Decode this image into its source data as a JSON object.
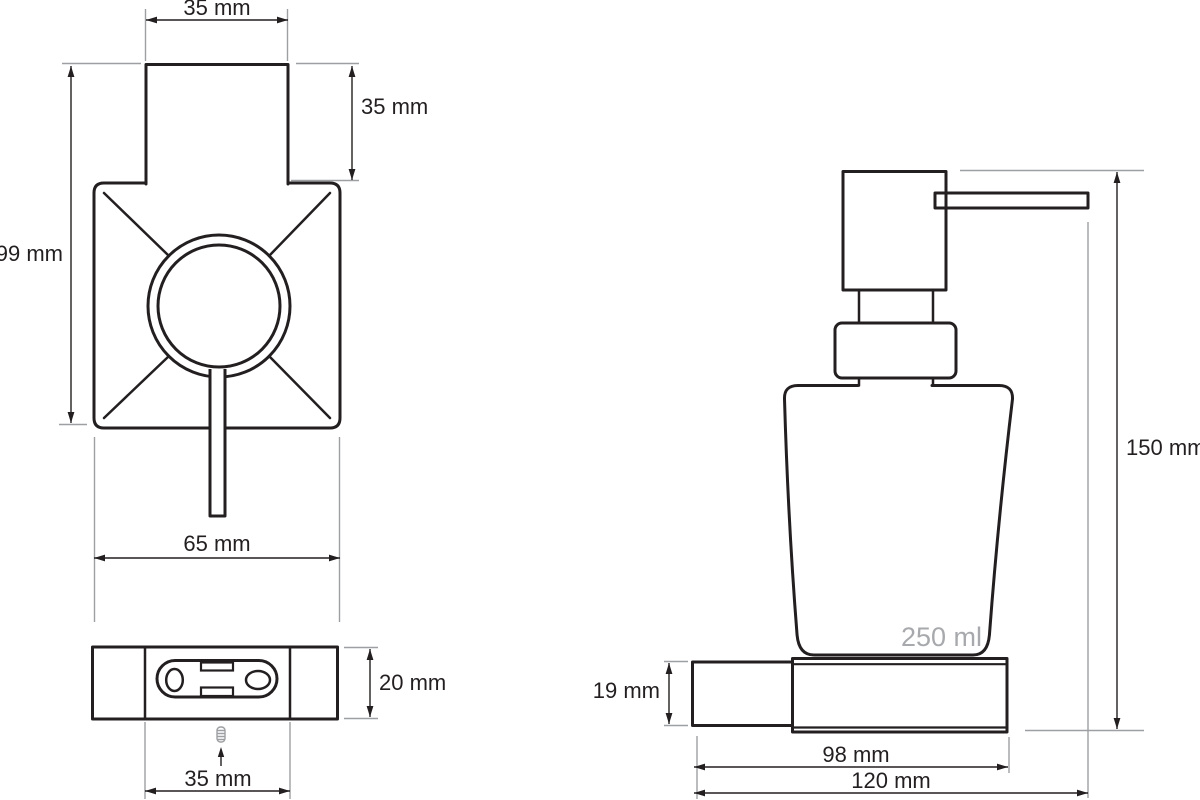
{
  "front_view": {
    "top_width": "35 mm",
    "pump_height": "35 mm",
    "total_height": "99 mm",
    "bottom_width": "65 mm"
  },
  "bottom_view": {
    "depth": "20 mm",
    "center_width": "35 mm"
  },
  "side_view": {
    "total_height": "150 mm",
    "holder_height": "19 mm",
    "holder_width": "98 mm",
    "total_width": "120 mm",
    "capacity": "250 ml"
  },
  "colors": {
    "outline": "#231f20",
    "dimension_line": "#231f20",
    "extension_line": "#9d9fa2",
    "capacity_text": "#a7a9ac",
    "background": "#ffffff"
  }
}
